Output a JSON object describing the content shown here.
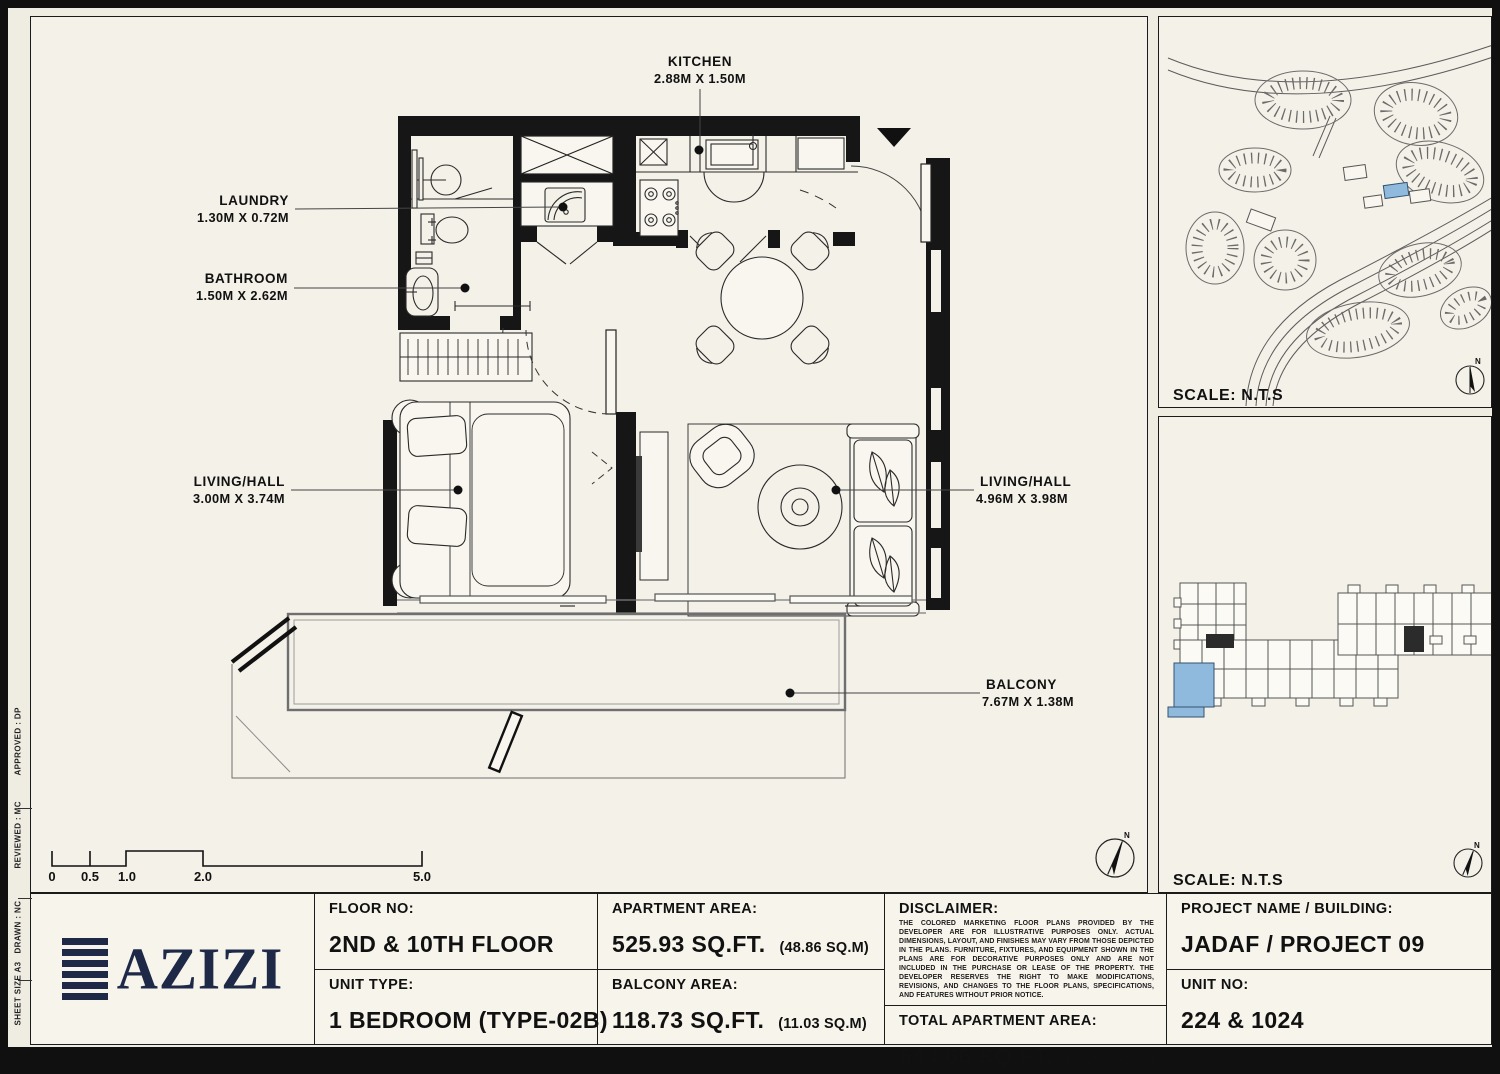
{
  "plan": {
    "labels": [
      {
        "name": "KITCHEN",
        "dims": "2.88M X 1.50M"
      },
      {
        "name": "LAUNDRY",
        "dims": "1.30M X 0.72M"
      },
      {
        "name": "BATHROOM",
        "dims": "1.50M X 2.62M"
      },
      {
        "name": "LIVING/HALL",
        "dims": "3.00M X 3.74M"
      },
      {
        "name": "LIVING/HALL",
        "dims": "4.96M X 3.98M"
      },
      {
        "name": "BALCONY",
        "dims": "7.67M X 1.38M"
      }
    ],
    "scale_bar": {
      "ticks": [
        "0",
        "0.5",
        "1.0",
        "2.0",
        "5.0"
      ]
    },
    "north_label": "N"
  },
  "panels": {
    "site_map_scale": "SCALE: N.T.S",
    "key_plan_scale": "SCALE: N.T.S",
    "highlight_color": "#8fbade"
  },
  "title_block": {
    "logo_text": "AZIZI",
    "logo_color": "#1d2947",
    "floor_no_label": "FLOOR NO:",
    "floor_no": "2ND & 10TH FLOOR",
    "unit_type_label": "UNIT TYPE:",
    "unit_type": "1 BEDROOM (TYPE-02B)",
    "apartment_area_label": "APARTMENT AREA:",
    "apartment_area": "525.93 SQ.FT.",
    "apartment_area_m": "(48.86 SQ.M)",
    "balcony_area_label": "BALCONY AREA:",
    "balcony_area": "118.73 SQ.FT.",
    "balcony_area_m": "(11.03 SQ.M)",
    "disclaimer_label": "DISCLAIMER:",
    "disclaimer_text": "THE COLORED MARKETING FLOOR PLANS PROVIDED BY THE DEVELOPER ARE FOR ILLUSTRATIVE PURPOSES ONLY. ACTUAL DIMENSIONS, LAYOUT, AND FINISHES MAY VARY FROM THOSE DEPICTED IN THE PLANS. FURNITURE, FIXTURES, AND EQUIPMENT SHOWN IN THE PLANS ARE FOR DECORATIVE PURPOSES ONLY AND ARE NOT INCLUDED IN THE PURCHASE OR LEASE OF THE PROPERTY. THE DEVELOPER RESERVES THE RIGHT TO MAKE MODIFICATIONS, REVISIONS, AND CHANGES TO THE FLOOR PLANS, SPECIFICATIONS, AND FEATURES WITHOUT PRIOR NOTICE.",
    "total_area_label": "TOTAL APARTMENT AREA:",
    "total_area": "644.66 SQ.FT.",
    "total_area_m": "(59.89 SQ.M)",
    "project_label": "PROJECT NAME / BUILDING:",
    "project": "JADAF / PROJECT 09",
    "unit_no_label": "UNIT NO:",
    "unit_no": "224 & 1024"
  },
  "margin_notes": {
    "sheet": "SHEET SIZE  A3",
    "drawn": "DRAWN :   NC",
    "reviewed": "REVIEWED :   MC",
    "approved": "APPROVED :   DP"
  }
}
